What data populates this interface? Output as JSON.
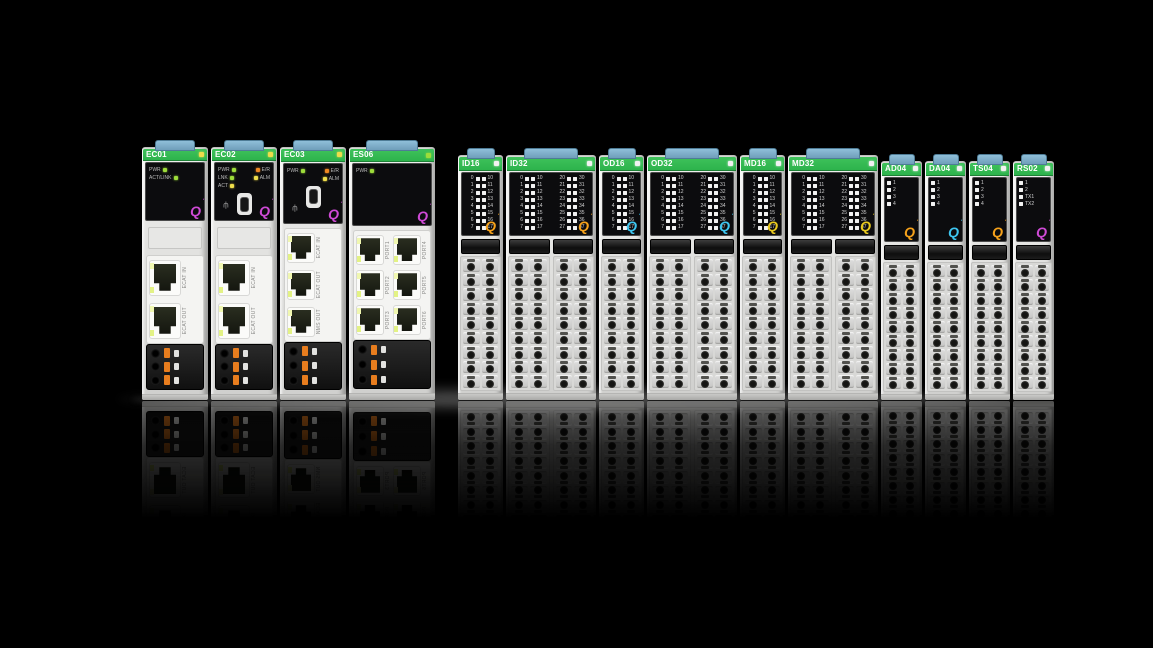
{
  "logo_glyph": "Q",
  "colors": {
    "strip_green": "#2db34c",
    "led_green": "#9ddc3a",
    "led_orange": "#ee8822",
    "led_yellow": "#efdd4a",
    "led_white": "#f2f2f2",
    "q_purple": "#cf4ad6",
    "q_orange": "#f6a21b",
    "q_cyan": "#3ec6f0",
    "q_yellow": "#e9c91f",
    "clip_blue": "#8fbfd9",
    "connector_orange": "#e87d1e"
  },
  "channels": {
    "g0": [
      "0",
      "1",
      "2",
      "3",
      "4",
      "5",
      "6",
      "7"
    ],
    "g1": [
      "10",
      "11",
      "12",
      "13",
      "14",
      "15",
      "16",
      "17"
    ],
    "g2": [
      "20",
      "21",
      "22",
      "23",
      "24",
      "25",
      "26",
      "27"
    ],
    "g3": [
      "30",
      "31",
      "32",
      "33",
      "34",
      "35",
      "36",
      "37"
    ]
  },
  "modules": [
    {
      "label": "EC01",
      "type": "ec",
      "width": 66,
      "q": "purple",
      "label_led": "yellow",
      "usb": false,
      "panel_rows": [
        [
          {
            "t": "PWR",
            "c": "green"
          }
        ],
        [
          {
            "t": "ACT/LINK",
            "c": "green"
          }
        ]
      ],
      "ports": [
        "ECAT IN",
        "ECAT OUT"
      ]
    },
    {
      "label": "EC02",
      "type": "ec",
      "width": 66,
      "q": "purple",
      "label_led": "yellow",
      "usb": true,
      "panel_rows": [
        [
          {
            "t": "PWR",
            "c": "green"
          },
          {
            "t": "E/R",
            "c": "orange"
          }
        ],
        [
          {
            "t": "LNK",
            "c": "green"
          },
          {
            "t": "ALM",
            "c": "yellow"
          }
        ],
        [
          {
            "t": "ACT",
            "c": "yellow"
          }
        ]
      ],
      "ports": [
        "ECAT IN",
        "ECAT OUT"
      ]
    },
    {
      "label": "EC03",
      "type": "ec",
      "width": 66,
      "q": "purple",
      "label_led": "yellow",
      "usb": true,
      "panel_rows": [
        [
          {
            "t": "PWR",
            "c": "green"
          },
          {
            "t": "E/R",
            "c": "orange"
          }
        ],
        [
          {
            "t": "",
            "c": "none"
          },
          {
            "t": "ALM",
            "c": "yellow"
          }
        ]
      ],
      "ports": [
        "ECAT IN",
        "ECAT OUT",
        "NMS OUT"
      ]
    },
    {
      "label": "ES06",
      "type": "es",
      "width": 86,
      "q": "purple",
      "label_led": "green",
      "usb": false,
      "panel_rows": [
        [
          {
            "t": "PWR",
            "c": "green"
          }
        ]
      ],
      "port_pairs": [
        [
          "PORT1",
          "PORT4"
        ],
        [
          "PORT2",
          "PORT5"
        ],
        [
          "PORT3",
          "PORT6"
        ]
      ]
    },
    {
      "label": "ID16",
      "type": "io16",
      "width": 45,
      "q": "orange",
      "label_led": "white",
      "groups": [
        [
          "g0",
          "g1"
        ]
      ]
    },
    {
      "label": "ID32",
      "type": "io32",
      "width": 90,
      "q": "orange",
      "label_led": "white",
      "groups": [
        [
          "g0",
          "g1"
        ],
        [
          "g2",
          "g3"
        ]
      ]
    },
    {
      "label": "OD16",
      "type": "io16",
      "width": 45,
      "q": "cyan",
      "label_led": "white",
      "groups": [
        [
          "g0",
          "g1"
        ]
      ]
    },
    {
      "label": "OD32",
      "type": "io32",
      "width": 90,
      "q": "cyan",
      "label_led": "white",
      "groups": [
        [
          "g0",
          "g1"
        ],
        [
          "g2",
          "g3"
        ]
      ]
    },
    {
      "label": "MD16",
      "type": "io16",
      "width": 45,
      "q": "yellow",
      "label_led": "white",
      "groups": [
        [
          "g0",
          "g1"
        ]
      ]
    },
    {
      "label": "MD32",
      "type": "io32",
      "width": 90,
      "q": "yellow",
      "label_led": "white",
      "groups": [
        [
          "g0",
          "g1"
        ],
        [
          "g2",
          "g3"
        ]
      ]
    },
    {
      "label": "AD04",
      "type": "analog",
      "width": 41,
      "q": "orange",
      "label_led": "white",
      "led_labels": [
        "1",
        "2",
        "3",
        "4"
      ]
    },
    {
      "label": "DA04",
      "type": "analog",
      "width": 41,
      "q": "cyan",
      "label_led": "white",
      "led_labels": [
        "1",
        "2",
        "3",
        "4"
      ]
    },
    {
      "label": "TS04",
      "type": "analog",
      "width": 41,
      "q": "orange",
      "label_led": "white",
      "led_labels": [
        "1",
        "2",
        "3",
        "4"
      ]
    },
    {
      "label": "RS02",
      "type": "analog",
      "width": 41,
      "q": "purple",
      "label_led": "white",
      "led_labels": [
        "1",
        "2",
        "TX1",
        "TX2"
      ]
    }
  ]
}
